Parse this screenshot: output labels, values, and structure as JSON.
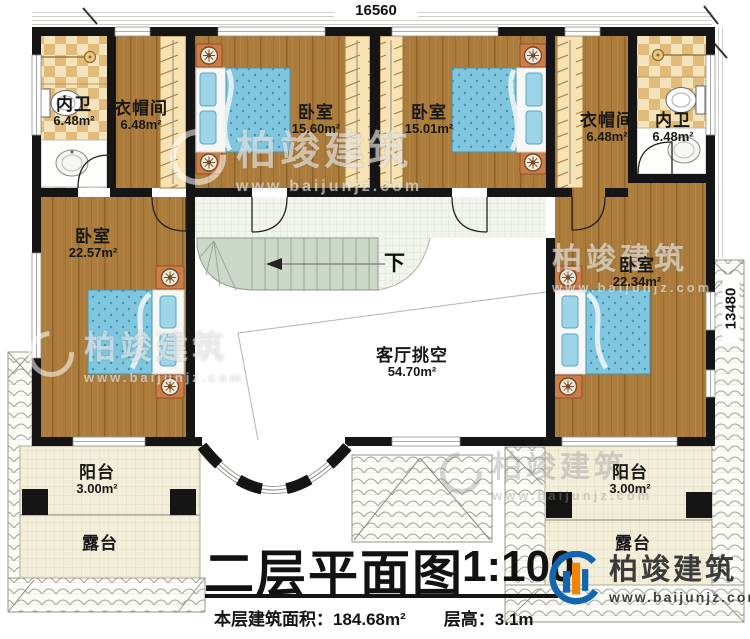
{
  "dimensions": {
    "top": "16560",
    "right": "13480"
  },
  "stairs": {
    "down_label": "下"
  },
  "rooms": [
    {
      "name": "内卫",
      "area": "6.48m²"
    },
    {
      "name": "衣帽间",
      "area": "6.48m²"
    },
    {
      "name": "卧室",
      "area": "15.60m²"
    },
    {
      "name": "卧室",
      "area": "15.01m²"
    },
    {
      "name": "衣帽间",
      "area": "6.48m²"
    },
    {
      "name": "内卫",
      "area": "6.48m²"
    },
    {
      "name": "卧室",
      "area": "22.57m²"
    },
    {
      "name": "卧室",
      "area": "22.34m²"
    },
    {
      "name": "客厅挑空",
      "area": "54.70m²"
    },
    {
      "name": "阳台",
      "area": "3.00m²"
    },
    {
      "name": "露台",
      "area": ""
    },
    {
      "name": "阳台",
      "area": "3.00m²"
    },
    {
      "name": "露台",
      "area": ""
    }
  ],
  "watermark": {
    "brand": "柏竣建筑",
    "url": "www.baijunjz.com"
  },
  "logo": {
    "brand": "柏竣建筑",
    "url": "www.baijunjz.com"
  },
  "title": {
    "main": "二层平面图",
    "scale": "1:100",
    "area_label": "本层建筑面积：",
    "area_value": "184.68m²",
    "floor_height_label": "层高：",
    "floor_height_value": "3.1m"
  },
  "colors": {
    "wall": "#151515",
    "wood_floor": "#ab7c3b",
    "bath_tile_light": "#f4e4bd",
    "bath_tile_dark": "#e2ba7a",
    "bed_blue": "#7fc6de",
    "stair_green": "#ccd8c8",
    "nightstand_orange": "#cb7c47",
    "logo_blue": "#1266b0",
    "logo_orange": "#f08300"
  }
}
